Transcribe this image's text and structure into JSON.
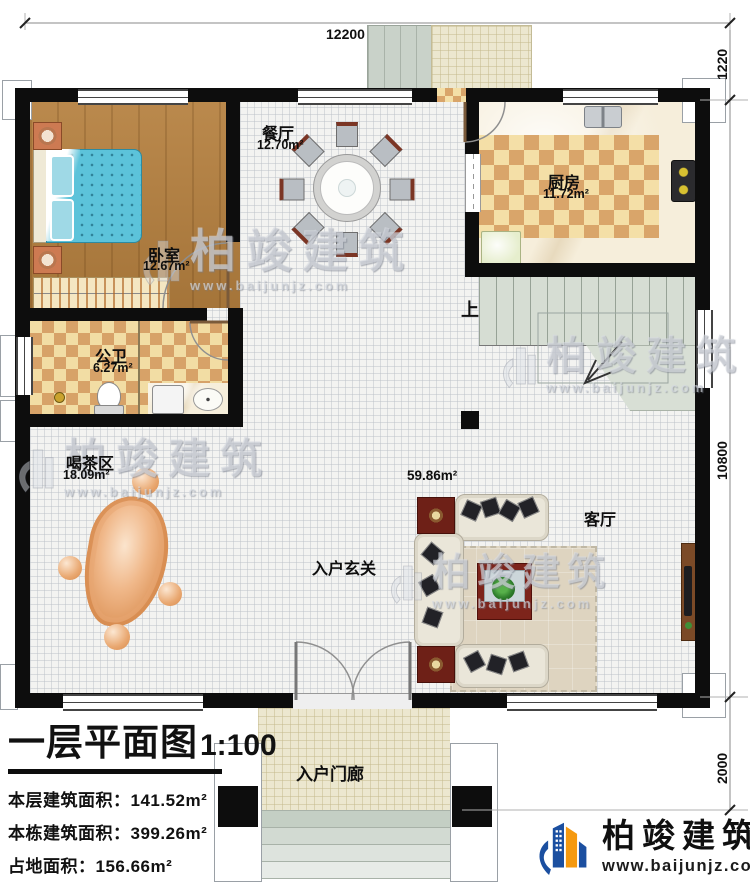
{
  "dimensions": {
    "top": "12200",
    "right_upper": "1220",
    "right_middle": "10800",
    "right_lower": "2000"
  },
  "rooms": {
    "bedroom": {
      "name": "卧室",
      "area": "12.67m²"
    },
    "dining": {
      "name": "餐厅",
      "area": "12.70m²"
    },
    "kitchen": {
      "name": "厨房",
      "area": "11.72m²"
    },
    "bathroom": {
      "name": "公卫",
      "area": "6.27m²"
    },
    "tea": {
      "name": "喝茶区",
      "area": "18.09m²"
    },
    "living": {
      "name": "客厅",
      "area": "59.86m²"
    },
    "foyer": {
      "name": "入户玄关"
    },
    "porch": {
      "name": "入户门廊"
    },
    "stairs": {
      "up_label": "上"
    }
  },
  "info_block": {
    "title": "一层平面图",
    "scale": "1:100",
    "lines": [
      {
        "label": "本层建筑面积：",
        "value": "141.52m²"
      },
      {
        "label": "本栋建筑面积：",
        "value": "399.26m²"
      },
      {
        "label": "占地面积：",
        "value": "156.66m²"
      },
      {
        "label": "层高：",
        "value": "3.6m"
      }
    ]
  },
  "watermark": {
    "brand": "柏竣建筑",
    "url": "www.baijunjz.com"
  },
  "brand_footer": {
    "name": "柏竣建筑",
    "url": "www.baijunjz.com",
    "blue": "#1b4fa0",
    "orange": "#f5990f"
  }
}
